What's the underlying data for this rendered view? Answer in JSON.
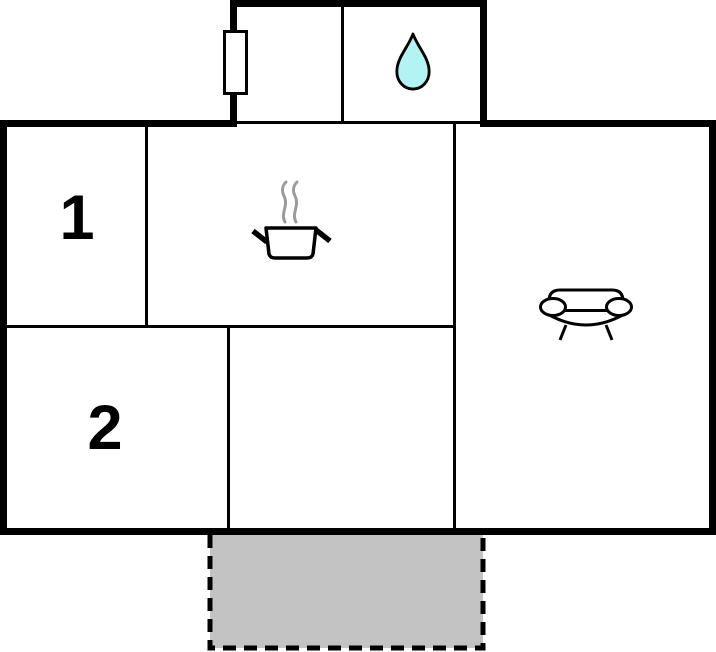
{
  "floorplan": {
    "rooms": [
      {
        "label": "1"
      },
      {
        "label": "2"
      }
    ],
    "icons": [
      "window-radiator-icon",
      "water-drop-icon",
      "cooking-pot-icon",
      "steam-icon",
      "sofa-icon"
    ],
    "palette": {
      "wall": "#000000",
      "background": "#ffffff",
      "water_drop_fill": "#b2f3f3",
      "steam_gray": "#9b9b9b",
      "terrace_fill": "#c3c3c3",
      "room_fill": "#ffffff"
    }
  }
}
